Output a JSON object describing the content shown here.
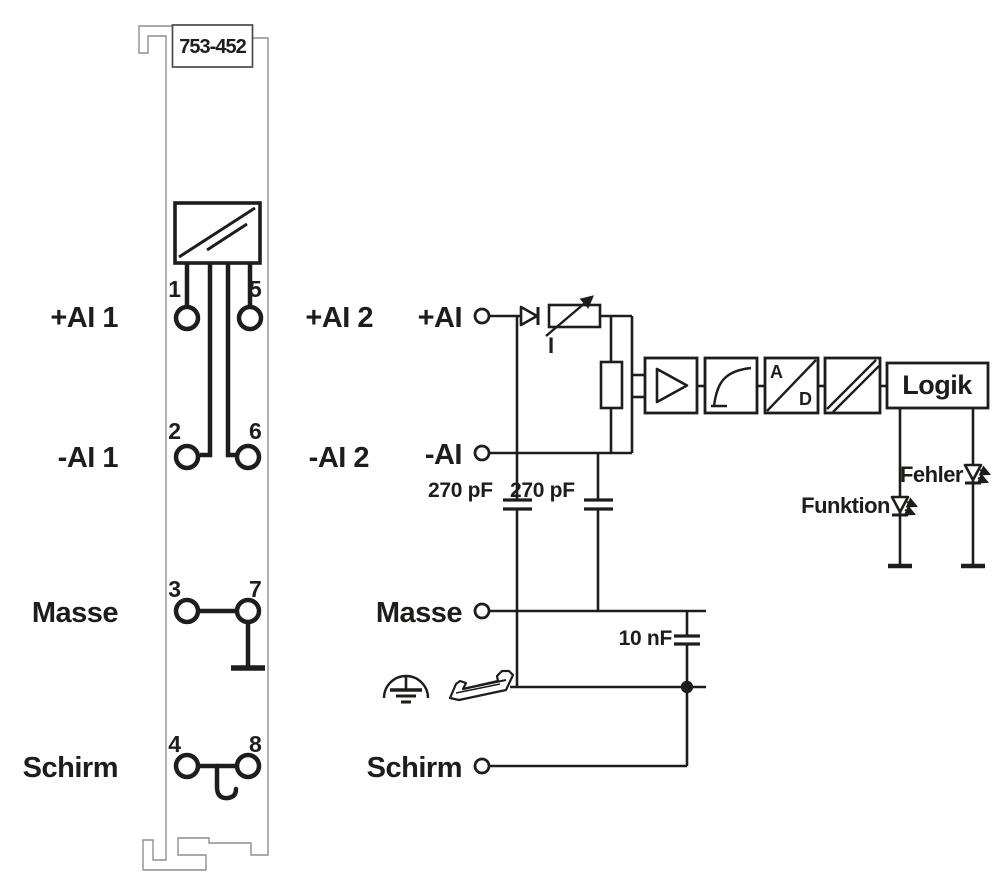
{
  "module": {
    "part_number": "753-452",
    "terminals": [
      "1",
      "2",
      "3",
      "4",
      "5",
      "6",
      "7",
      "8"
    ]
  },
  "labels": {
    "left": [
      "+AI 1",
      "-AI 1",
      "Masse",
      "Schirm"
    ],
    "mid": [
      "+AI 2",
      "-AI 2"
    ]
  },
  "schematic": {
    "inputs": [
      "+AI",
      "-AI",
      "Masse",
      "Schirm"
    ],
    "current_source": "I",
    "caps": [
      "270 pF",
      "270 pF",
      "10 nF"
    ],
    "adc": {
      "a": "A",
      "d": "D"
    },
    "logic": "Logik",
    "led_error": "Fehler",
    "led_function": "Funktion"
  },
  "colors": {
    "line": "#1d1d1b",
    "outline": "#8f8f8f",
    "background": "#ffffff"
  }
}
